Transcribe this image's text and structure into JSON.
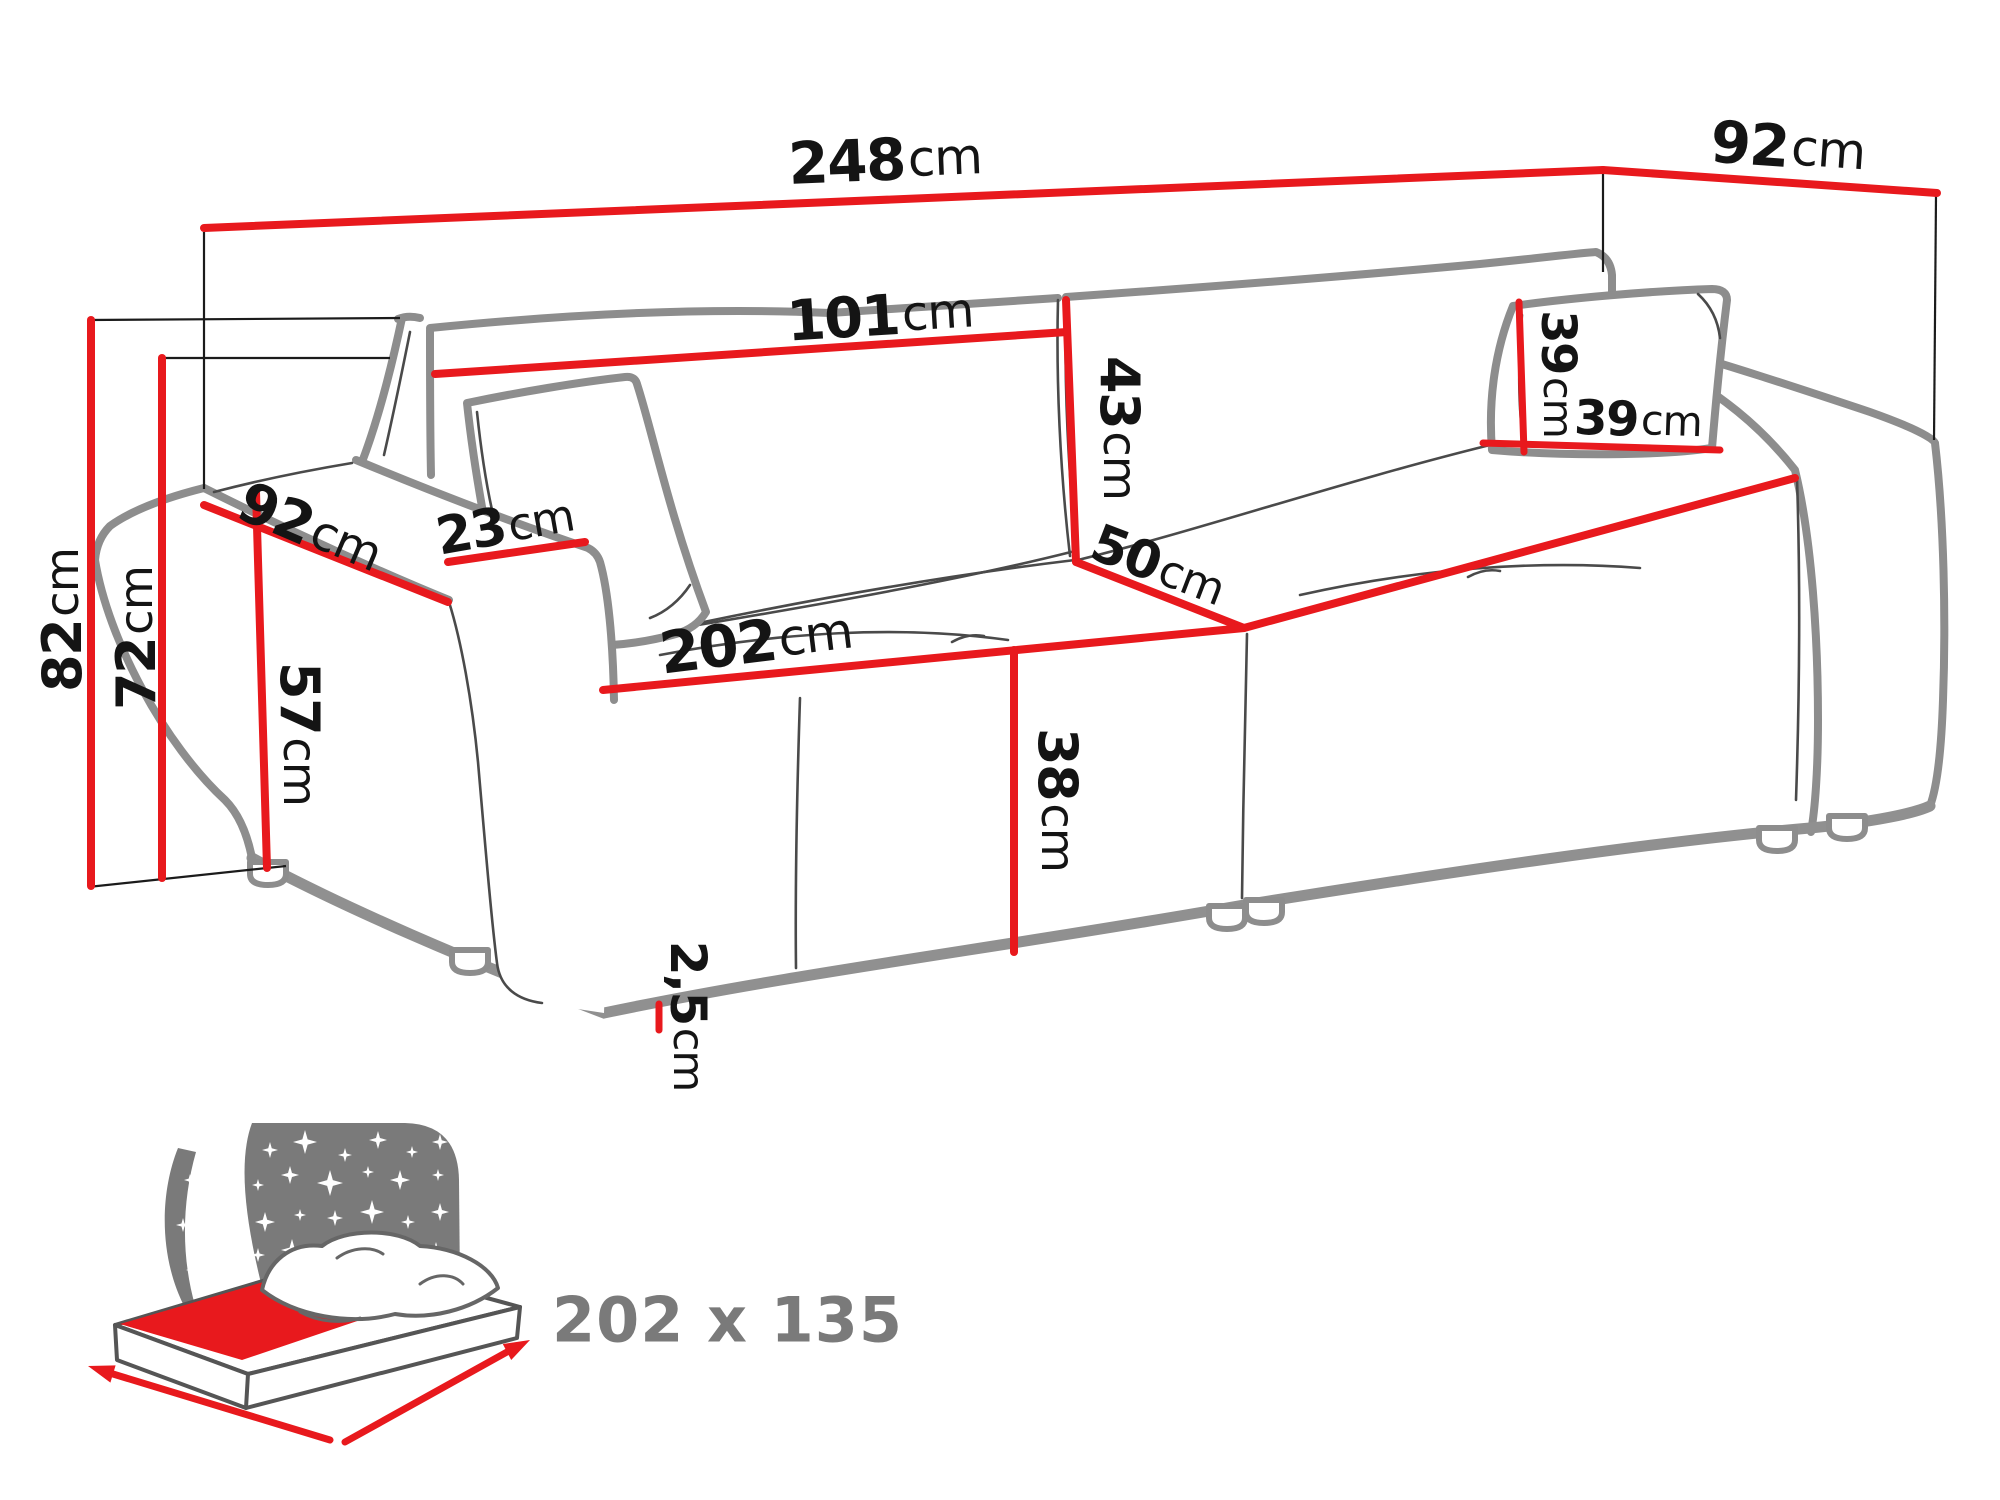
{
  "title": "Sofa bed dimensions technical diagram",
  "default_unit": "cm",
  "dimensions": {
    "total_width": {
      "value": "248",
      "unit": "cm"
    },
    "total_depth": {
      "value": "92",
      "unit": "cm"
    },
    "backrest_cushion_width": {
      "value": "101",
      "unit": "cm"
    },
    "backrest_cushion_height": {
      "value": "43",
      "unit": "cm"
    },
    "seat_depth": {
      "value": "50",
      "unit": "cm"
    },
    "seat_front_width": {
      "value": "202",
      "unit": "cm"
    },
    "seat_height": {
      "value": "38",
      "unit": "cm"
    },
    "leg_height": {
      "value": "2,5",
      "unit": "cm"
    },
    "total_height": {
      "value": "82",
      "unit": "cm"
    },
    "backrest_height": {
      "value": "72",
      "unit": "cm"
    },
    "armrest_height": {
      "value": "57",
      "unit": "cm"
    },
    "armrest_depth": {
      "value": "92",
      "unit": "cm"
    },
    "armrest_width": {
      "value": "23",
      "unit": "cm"
    },
    "pillow_height": {
      "value": "39",
      "unit": "cm"
    },
    "pillow_width": {
      "value": "39",
      "unit": "cm"
    }
  },
  "sleeping_function": {
    "bed_size_label": "202 x 135"
  },
  "colors": {
    "red": "#e8191d",
    "outline": "#8d8d8d",
    "thinline": "#4a4a4a",
    "construction": "#1b1b1b",
    "text": "#141414",
    "icon": "#7a7a7a"
  }
}
